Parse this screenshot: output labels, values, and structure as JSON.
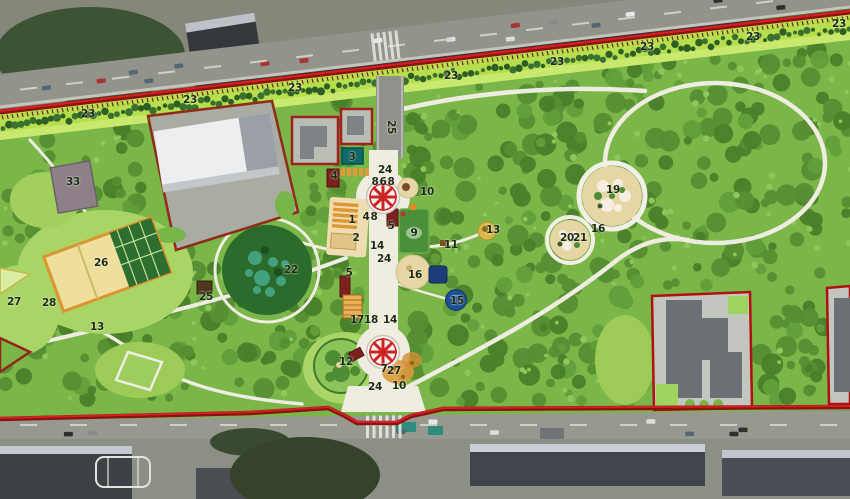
{
  "map": {
    "markers": [
      {
        "t": "23",
        "x": 88,
        "y": 114
      },
      {
        "t": "23",
        "x": 190,
        "y": 100
      },
      {
        "t": "23",
        "x": 295,
        "y": 88
      },
      {
        "t": "23",
        "x": 451,
        "y": 76
      },
      {
        "t": "23",
        "x": 557,
        "y": 62
      },
      {
        "t": "23",
        "x": 647,
        "y": 47
      },
      {
        "t": "23",
        "x": 753,
        "y": 37
      },
      {
        "t": "23",
        "x": 839,
        "y": 24
      },
      {
        "t": "25",
        "x": 391,
        "y": 127,
        "r": 90
      },
      {
        "t": "25",
        "x": 206,
        "y": 297
      },
      {
        "t": "24",
        "x": 385,
        "y": 170
      },
      {
        "t": "24",
        "x": 384,
        "y": 259
      },
      {
        "t": "24",
        "x": 375,
        "y": 387
      },
      {
        "t": "8",
        "x": 375,
        "y": 182
      },
      {
        "t": "6",
        "x": 383,
        "y": 182
      },
      {
        "t": "8",
        "x": 391,
        "y": 182
      },
      {
        "t": "1",
        "x": 352,
        "y": 220
      },
      {
        "t": "2",
        "x": 356,
        "y": 238
      },
      {
        "t": "3",
        "x": 352,
        "y": 157
      },
      {
        "t": "4",
        "x": 334,
        "y": 176
      },
      {
        "t": "4",
        "x": 366,
        "y": 217
      },
      {
        "t": "8",
        "x": 374,
        "y": 217
      },
      {
        "t": "5",
        "x": 391,
        "y": 226
      },
      {
        "t": "5",
        "x": 349,
        "y": 273
      },
      {
        "t": "7",
        "x": 384,
        "y": 369
      },
      {
        "t": "9",
        "x": 414,
        "y": 233
      },
      {
        "t": "10",
        "x": 427,
        "y": 192
      },
      {
        "t": "10",
        "x": 399,
        "y": 386
      },
      {
        "t": "11",
        "x": 451,
        "y": 245
      },
      {
        "t": "12",
        "x": 346,
        "y": 362
      },
      {
        "t": "13",
        "x": 493,
        "y": 230
      },
      {
        "t": "13",
        "x": 97,
        "y": 327
      },
      {
        "t": "14",
        "x": 377,
        "y": 246
      },
      {
        "t": "14",
        "x": 390,
        "y": 320
      },
      {
        "t": "15",
        "x": 457,
        "y": 301
      },
      {
        "t": "16",
        "x": 415,
        "y": 275
      },
      {
        "t": "16",
        "x": 598,
        "y": 229
      },
      {
        "t": "17",
        "x": 357,
        "y": 320
      },
      {
        "t": "18",
        "x": 371,
        "y": 320
      },
      {
        "t": "19",
        "x": 613,
        "y": 190
      },
      {
        "t": "20",
        "x": 567,
        "y": 238
      },
      {
        "t": "21",
        "x": 580,
        "y": 238
      },
      {
        "t": "22",
        "x": 291,
        "y": 270
      },
      {
        "t": "26",
        "x": 101,
        "y": 263
      },
      {
        "t": "27",
        "x": 394,
        "y": 371
      },
      {
        "t": "27",
        "x": 14,
        "y": 302
      },
      {
        "t": "28",
        "x": 49,
        "y": 303
      },
      {
        "t": "33",
        "x": 73,
        "y": 182
      }
    ],
    "colors": {
      "boundary_red": "#d42020",
      "boundary_dark": "#8c1212",
      "strip_green": "#b6de4d",
      "park_green": "#7ab648",
      "path_white": "#efece2",
      "carousel_red": "#cc2424",
      "water_blue": "#1d4f92",
      "accent_orange": "#e09633"
    }
  }
}
